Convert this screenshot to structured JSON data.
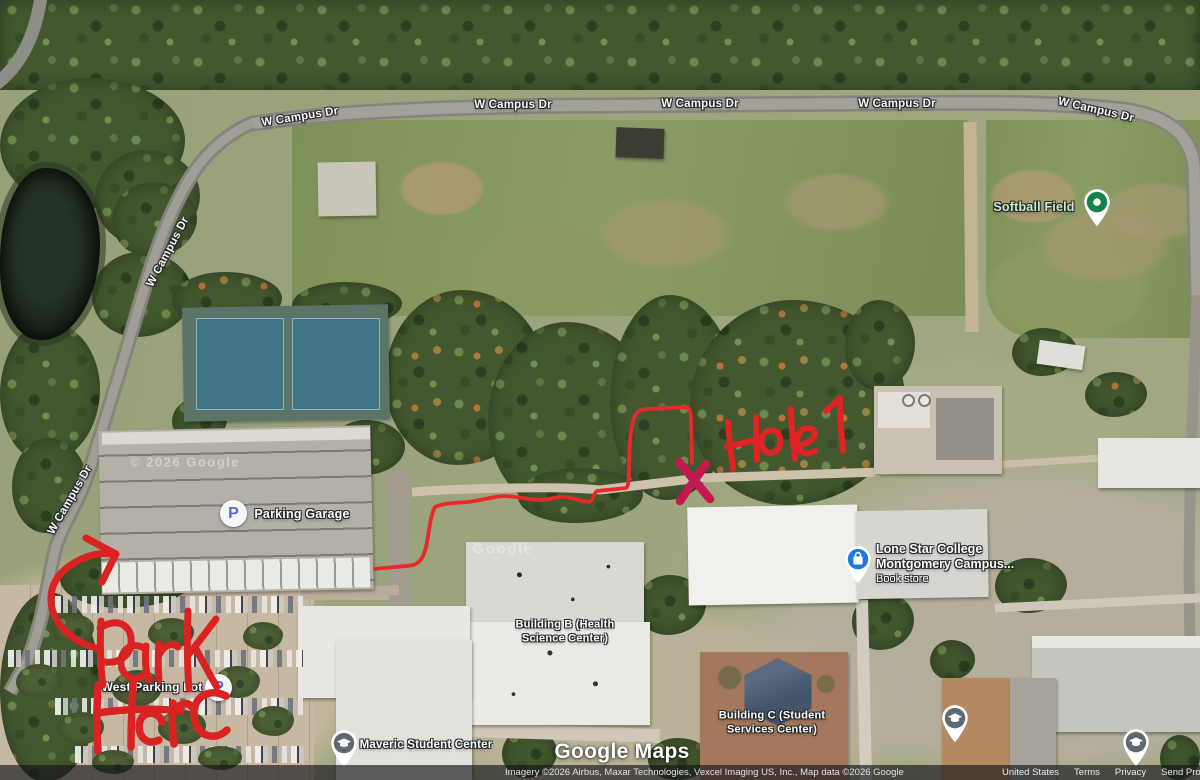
{
  "road_labels": [
    {
      "text": "W Campus Dr"
    },
    {
      "text": "W Campus Dr"
    },
    {
      "text": "W Campus Dr"
    },
    {
      "text": "W Campus Dr"
    },
    {
      "text": "W Campus Dr"
    },
    {
      "text": "W Campus Dr"
    },
    {
      "text": "W Campus Dr"
    }
  ],
  "pois": {
    "softball": {
      "label": "Softball Field"
    },
    "parking_garage": {
      "label": "Parking Garage",
      "icon_letter": "P"
    },
    "west_lot": {
      "label": "West Parking Lot",
      "icon_letter": "P"
    },
    "lsc": {
      "line1": "Lone Star College",
      "line2": "Montgomery Campus...",
      "sub": "Book store"
    },
    "building_b": {
      "line1": "Building B (Health",
      "line2": "Science Center)"
    },
    "building_c": {
      "line1": "Building C (Student",
      "line2": "Services Center)"
    },
    "maveric": {
      "label": "Maveric Student Center"
    }
  },
  "imagery_watermarks": [
    {
      "text": "© 2026 Google"
    },
    {
      "text": "Google"
    },
    {
      "text": "© 2026 Goo"
    }
  ],
  "logo": {
    "text": "Google Maps"
  },
  "attribution": {
    "imagery": "Imagery ©2026 Airbus, Maxar Technologies, Vexcel Imaging US, Inc., Map data ©2026 Google",
    "links": [
      {
        "label": "United States"
      },
      {
        "label": "Terms"
      },
      {
        "label": "Privacy"
      },
      {
        "label": "Send Product Feedback"
      }
    ]
  },
  "annotations": {
    "park": "Park",
    "here": "Here",
    "hole": "Hole 1",
    "x_mark": "X",
    "ink_color": "#d92322",
    "x_color": "#c21a4f"
  },
  "colors": {
    "pin_green": "#12824d",
    "pin_blue": "#1d79e0",
    "pin_slate": "#5c6a73",
    "parking_p_blue": "#5b6bd0"
  }
}
